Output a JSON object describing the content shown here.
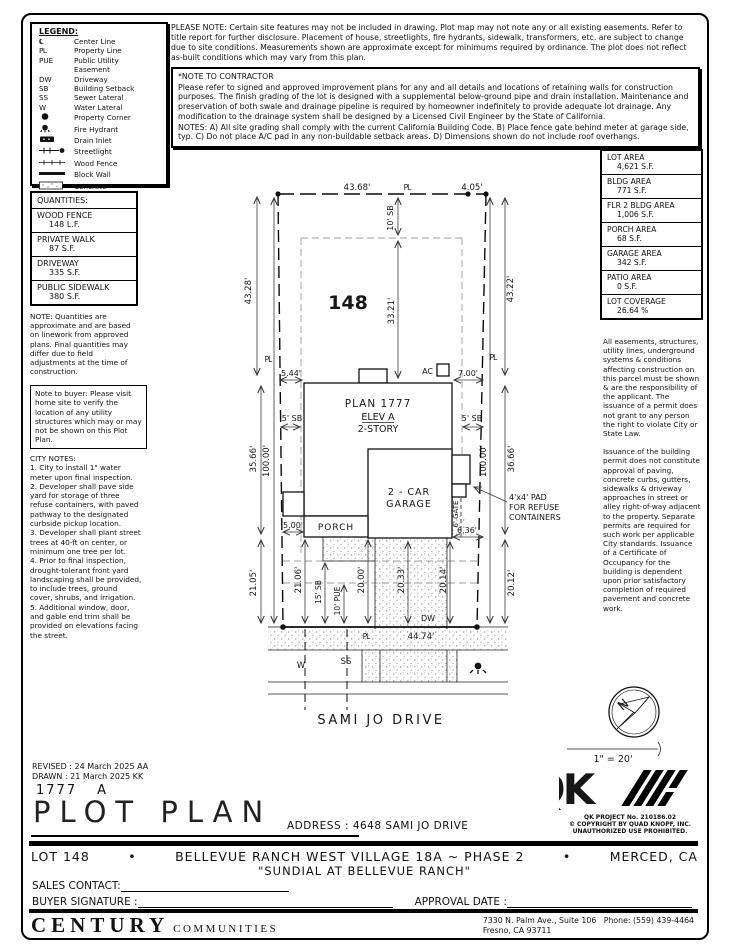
{
  "legend": {
    "title": "LEGEND:",
    "items": [
      {
        "sym": "℄",
        "label": "Center Line"
      },
      {
        "sym": "PL",
        "label": "Property Line"
      },
      {
        "sym": "PUE",
        "label": "Public Utility"
      },
      {
        "sym": "",
        "label": "Easement"
      },
      {
        "sym": "DW",
        "label": "Driveway"
      },
      {
        "sym": "SB",
        "label": "Building Setback"
      },
      {
        "sym": "SS",
        "label": "Sewer Lateral"
      },
      {
        "sym": "W",
        "label": "Water Lateral"
      },
      {
        "sym": "",
        "label": "Property Corner"
      },
      {
        "sym": "",
        "label": "Fire Hydrant"
      },
      {
        "sym": "",
        "label": "Drain Inlet"
      },
      {
        "sym": "",
        "label": "Streetlight"
      },
      {
        "sym": "",
        "label": "Wood Fence"
      },
      {
        "sym": "",
        "label": "Block Wall"
      },
      {
        "sym": "",
        "label": "Concrete"
      }
    ]
  },
  "notes": {
    "please_note": "PLEASE NOTE:  Certain site features may not be included in drawing. Plot map may not note any or all existing easements. Refer to title report for further disclosure. Placement of house, streetlights, fire hydrants, sidewalk, transformers, etc. are subject to change due to site conditions. Measurements shown are approximate except for minimums required by ordinance. The plot does not reflect as-built conditions which may vary from this plan.",
    "contractor_title": "*NOTE TO CONTRACTOR",
    "contractor_body": "Please refer to signed and approved improvement plans for any and all details and locations of retaining walls for construction purposes. The finish grading of the lot is designed with a supplemental below-ground pipe and drain installation. Maintenance and preservation of both swale and drainage pipeline is required by homeowner indefinitely to provide adequate lot drainage. Any modification to the drainage system shall be designed by a Licensed Civil Engineer by the State of California.",
    "contractor_notes": "NOTES:  A) All site grading shall comply with the current California Building Code.  B) Place fence gate behind meter at garage side, typ. C) Do not place A/C pad in any non-buildable setback areas.  D) Dimensions shown do not include roof overhangs.",
    "quantities_note": "NOTE: Quantities are approximate and are based on linework from approved plans.  Final quantities may differ due to field adjustments at the time of construction.",
    "buyer_note": "Note to buyer: Please visit home site to verify the location of any utility structures which may or may not be shown on this Plot Plan.",
    "city_notes_title": "CITY NOTES:",
    "city_notes": [
      "1. City to install 1\" water meter upon final inspection.",
      "2. Developer shall pave side yard for storage of three refuse containers, with paved pathway to the designated curbside pickup location.",
      "3. Developer shall plant street trees at 40-ft on center, or minimum one tree per lot.",
      "4. Prior to final inspection, drought-tolerant front yard landscaping shall be provided, to include trees, ground cover, shrubs, and irrigation.",
      "5. Additional window, door, and gable end trim shall be provided on elevations facing the street."
    ],
    "easement_note_1": "All easements, structures, utility lines, underground systems & conditions affecting construction on this parcel must be shown & are the responsibility of the applicant. The issuance of a permit does not grant to any person the right to violate City or State Law.",
    "easement_note_2": "Issuance of the building permit does not constitute approval of paving, concrete curbs, gutters, sidewalks & driveway approaches in street or alley right-of-way adjacent to the property. Separate permits are required for such work per applicable City standards. Issuance of a Certificate of Occupancy for the building is dependent upon prior satisfactory completion of required pavement and concrete work."
  },
  "quantities": {
    "title": "QUANTITIES:",
    "rows": [
      {
        "name": "WOOD FENCE",
        "value": "148 L.F."
      },
      {
        "name": "PRIVATE WALK",
        "value": "87 S.F."
      },
      {
        "name": "DRIVEWAY",
        "value": "335 S.F."
      },
      {
        "name": "PUBLIC SIDEWALK",
        "value": "380 S.F."
      }
    ]
  },
  "areas": {
    "rows": [
      {
        "name": "LOT AREA",
        "value": "4,621 S.F."
      },
      {
        "name": "BLDG AREA",
        "value": "771 S.F."
      },
      {
        "name": "FLR 2 BLDG AREA",
        "value": "1,006 S.F."
      },
      {
        "name": "PORCH AREA",
        "value": "68 S.F."
      },
      {
        "name": "GARAGE AREA",
        "value": "342 S.F."
      },
      {
        "name": "PATIO AREA",
        "value": "0 S.F."
      },
      {
        "name": "LOT COVERAGE",
        "value": "26.64 %"
      }
    ]
  },
  "plot": {
    "labels": {
      "lot_number": "148",
      "plan_line1": "PLAN 1777",
      "plan_line2": "ELEV A",
      "plan_line3": "2-STORY",
      "garage1": "2 - CAR",
      "garage2": "GARAGE",
      "porch": "PORCH",
      "ac": "AC",
      "gate": "6' GATE",
      "pad1": "4'x4' PAD",
      "pad2": "FOR REFUSE",
      "pad3": "CONTAINERS",
      "street": "SAMI JO DRIVE",
      "dw": "DW",
      "w": "W",
      "ss": "SS",
      "pl": "PL",
      "north": "N",
      "scale": "1\" = 20'"
    },
    "dims": {
      "top_width": "43.68'",
      "top_right": "4.05'",
      "left_outer": "43.28'",
      "right_outer": "43.22'",
      "rear_sb": "10' SB",
      "rear_to_house": "33.21'",
      "left_gap": "5.44'",
      "right_gap": "7.00'",
      "sb_left": "5' SB",
      "sb_right": "5' SB",
      "left_mid": "35.66'",
      "left_depth": "100.00'",
      "right_depth": "100.00'",
      "right_mid": "36.66'",
      "porch_step": "5.00'",
      "pad_width": "6.36'",
      "front_1": "21.05'",
      "front_2": "21.06'",
      "front_sb": "15' SB",
      "front_pue": "10' PUE",
      "front_3": "20.00'",
      "front_4": "20.33'",
      "front_5": "20.14'",
      "front_6": "20.12'",
      "frontage": "44.74'"
    }
  },
  "titleblock": {
    "revised": "REVISED :  24 March 2025  AA",
    "drawn": "DRAWN :  21 March 2025  KK",
    "plan_number": "1777",
    "plan_elev": "A",
    "title": "PLOT PLAN",
    "address": "ADDRESS :  4648 SAMI JO DRIVE",
    "qk_project": "QK PROJECT No. 210186.02",
    "qk_copyright": "© COPYRIGHT BY QUAD KNOPF, INC.",
    "qk_unauthorized": "UNAUTHORIZED USE PROHIBITED.",
    "lot_label": "LOT 148",
    "bullet1": "•",
    "community": "BELLEVUE RANCH WEST VILLAGE 18A ~ PHASE 2",
    "bullet2": "•",
    "city": "MERCED, CA",
    "subdivision": "\"SUNDIAL AT BELLEVUE RANCH\"",
    "sales_contact_label": "SALES CONTACT:",
    "buyer_signature_label": "BUYER SIGNATURE :",
    "approval_date_label": "APPROVAL DATE :",
    "builder_name": "CENTURY",
    "builder_sub": "COMMUNITIES",
    "builder_address": "7330 N. Palm Ave., Suite 106",
    "builder_phone": "Phone:  (559) 439-4464",
    "builder_city": "Fresno, CA  93711"
  }
}
